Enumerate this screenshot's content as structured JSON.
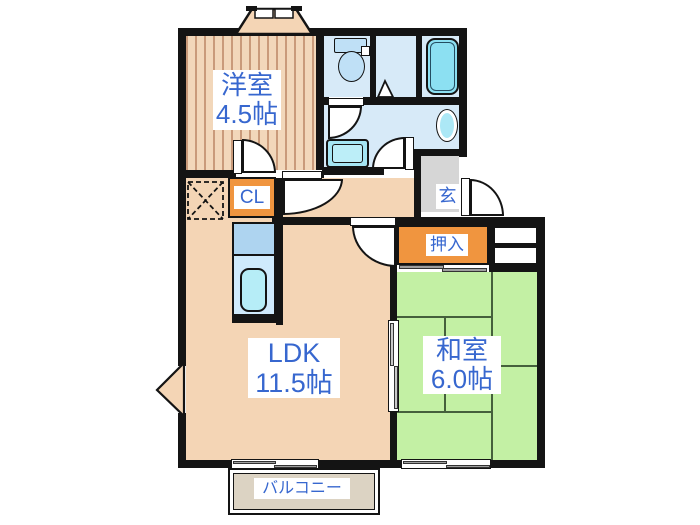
{
  "labels": {
    "western_room_name": "洋室",
    "western_room_size": "4.5帖",
    "ldk_name": "LDK",
    "ldk_size": "11.5帖",
    "japanese_room_name": "和室",
    "japanese_room_size": "6.0帖",
    "oshiire": "押入",
    "closet": "CL",
    "entrance": "玄",
    "balcony": "バルコニー"
  },
  "colors": {
    "wall": "#141414",
    "flooring_salmon": "#f4d5b5",
    "flooring_stripe": "#c99a7a",
    "tatami_green": "#c3f0a4",
    "tatami_line": "#45603c",
    "storage_orange": "#f0953f",
    "wet_area_blue": "#d7eaf8",
    "fixture_cyan": "#8ce0f2",
    "entrance_gray": "#d6d6d6",
    "balcony_beige": "#dcd3c3",
    "label_blue": "#3767cf"
  },
  "fixtures": [
    "toilet",
    "bathtub",
    "washbasin",
    "washing-machine-space",
    "kitchen-counter",
    "kitchen-sink",
    "refrigerator-space",
    "bay-window",
    "corner-bay-window",
    "entrance-door",
    "sliding-doors",
    "sliding-windows",
    "closet-shelves"
  ]
}
